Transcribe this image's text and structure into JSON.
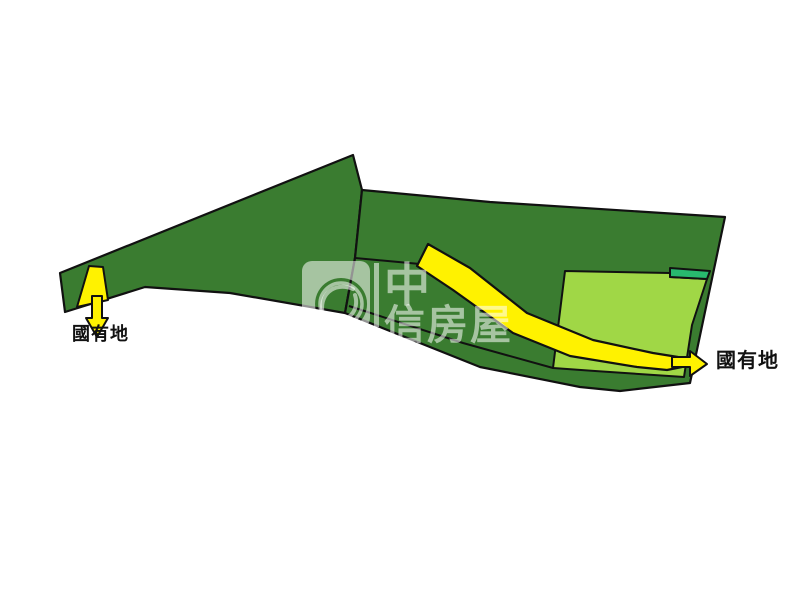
{
  "canvas": {
    "width": 800,
    "height": 600,
    "background": "#FFFFFF"
  },
  "colors": {
    "dark_green": "#3A7C30",
    "light_green": "#A0D746",
    "teal_green": "#28B96E",
    "yellow": "#FFF200",
    "outline": "#111111",
    "label_text": "#111111",
    "watermark": "rgba(255,255,255,0.55)"
  },
  "labels": {
    "left_state_land": "國有地",
    "right_state_land": "國有地"
  },
  "watermark": {
    "line1": "中",
    "line2": "信房屋",
    "brand": "中信房屋"
  },
  "map": {
    "description": "Land parcel sketch: dark green parcels with yellow state-owned-land strips and arrows",
    "shapes": [
      {
        "name": "parcel-left-dark-green",
        "type": "polygon",
        "fill": "dark_green",
        "stroke": "outline",
        "strokeWidth": 2.2,
        "points": [
          [
            353,
            155
          ],
          [
            362,
            190
          ],
          [
            355,
            258
          ],
          [
            345,
            313
          ],
          [
            230,
            293
          ],
          [
            145,
            287
          ],
          [
            65,
            312
          ],
          [
            60,
            273
          ]
        ]
      },
      {
        "name": "parcel-main-dark-green",
        "type": "polygon",
        "fill": "dark_green",
        "stroke": "outline",
        "strokeWidth": 2.2,
        "points": [
          [
            362,
            190
          ],
          [
            490,
            202
          ],
          [
            725,
            217
          ],
          [
            690,
            383
          ],
          [
            620,
            391
          ],
          [
            580,
            387
          ],
          [
            480,
            367
          ],
          [
            345,
            313
          ],
          [
            355,
            258
          ]
        ]
      },
      {
        "name": "parcel-divider-line",
        "type": "polyline",
        "stroke": "outline",
        "strokeWidth": 2,
        "points": [
          [
            355,
            258
          ],
          [
            420,
            264
          ]
        ]
      },
      {
        "name": "bottom-strip-line",
        "type": "polyline",
        "stroke": "outline",
        "strokeWidth": 2,
        "points": [
          [
            349,
            306
          ],
          [
            463,
            343
          ],
          [
            553,
            368
          ]
        ]
      },
      {
        "name": "parcel-light-green",
        "type": "polygon",
        "fill": "light_green",
        "stroke": "outline",
        "strokeWidth": 2,
        "points": [
          [
            565,
            271
          ],
          [
            670,
            273
          ],
          [
            670,
            277
          ],
          [
            707,
            279
          ],
          [
            692,
            325
          ],
          [
            684,
            377
          ],
          [
            595,
            371
          ],
          [
            553,
            368
          ]
        ]
      },
      {
        "name": "strip-teal-green",
        "type": "polygon",
        "fill": "teal_green",
        "stroke": "outline",
        "strokeWidth": 2,
        "points": [
          [
            670,
            268
          ],
          [
            710,
            271
          ],
          [
            707,
            279
          ],
          [
            670,
            277
          ]
        ]
      },
      {
        "name": "road-yellow-state-land",
        "type": "polygon",
        "fill": "yellow",
        "stroke": "outline",
        "strokeWidth": 2.2,
        "points": [
          [
            428,
            244
          ],
          [
            470,
            268
          ],
          [
            527,
            313
          ],
          [
            593,
            340
          ],
          [
            653,
            353
          ],
          [
            678,
            357
          ],
          [
            682,
            367
          ],
          [
            667,
            370
          ],
          [
            637,
            367
          ],
          [
            570,
            356
          ],
          [
            513,
            333
          ],
          [
            453,
            290
          ],
          [
            417,
            266
          ]
        ]
      },
      {
        "name": "state-land-left-parcel",
        "type": "polygon",
        "fill": "yellow",
        "stroke": "outline",
        "strokeWidth": 2,
        "points": [
          [
            89,
            266
          ],
          [
            103,
            267
          ],
          [
            108,
            300
          ],
          [
            77,
            307
          ]
        ]
      },
      {
        "name": "arrow-down",
        "type": "polygon",
        "fill": "yellow",
        "stroke": "outline",
        "strokeWidth": 2,
        "points": [
          [
            92,
            296
          ],
          [
            102,
            296
          ],
          [
            102,
            318
          ],
          [
            108,
            318
          ],
          [
            97,
            337
          ],
          [
            86,
            318
          ],
          [
            92,
            318
          ]
        ]
      },
      {
        "name": "arrow-right",
        "type": "polygon",
        "fill": "yellow",
        "stroke": "outline",
        "strokeWidth": 2,
        "points": [
          [
            672,
            357
          ],
          [
            690,
            357
          ],
          [
            690,
            351
          ],
          [
            707,
            364
          ],
          [
            690,
            376
          ],
          [
            690,
            367
          ],
          [
            672,
            367
          ]
        ]
      }
    ]
  }
}
